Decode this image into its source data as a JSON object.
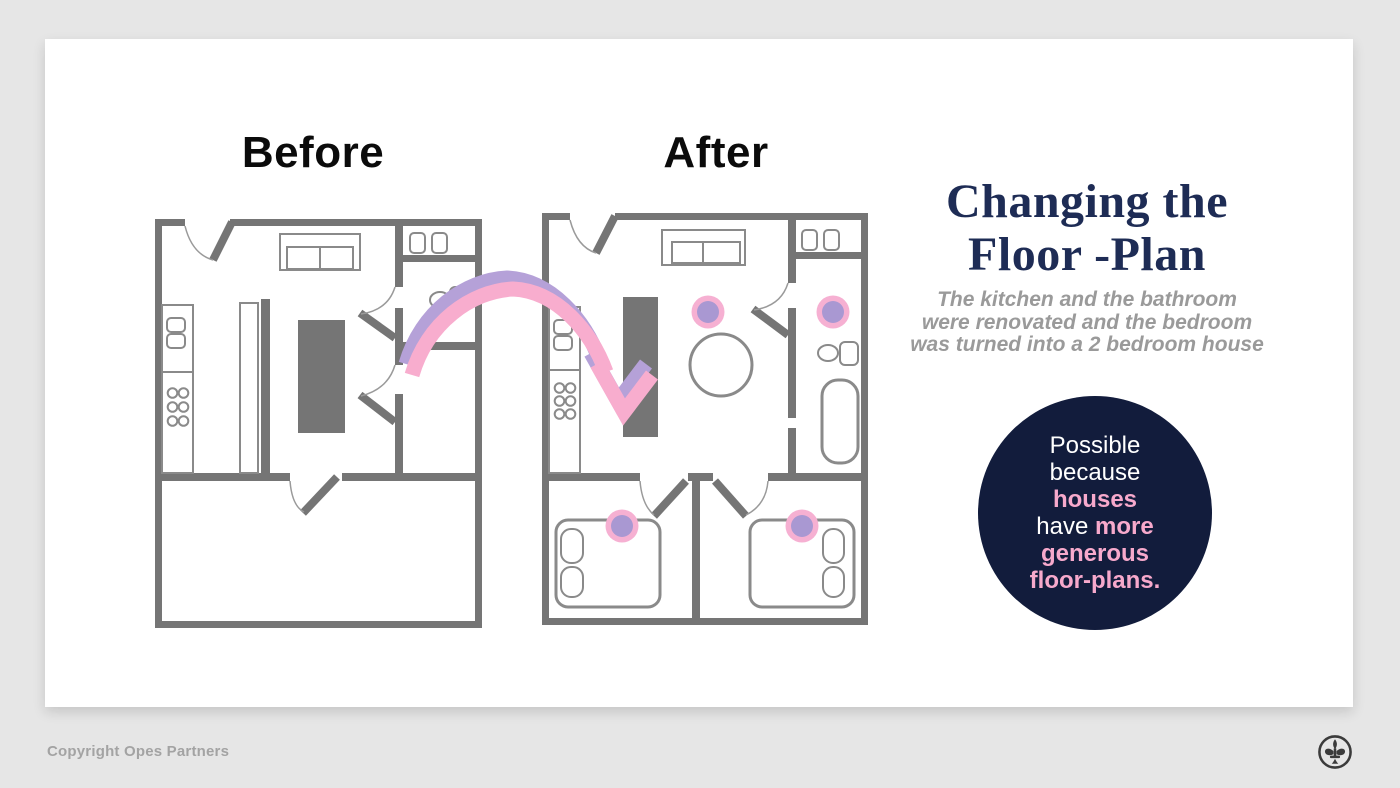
{
  "colors": {
    "page_background": "#e6e6e6",
    "card_background": "#ffffff",
    "wall_gray": "#757575",
    "outline_gray": "#8a8a8a",
    "arrow_pink": "#f8adce",
    "arrow_purple": "#b5a1d8",
    "marker_pink": "#f6b0d2",
    "marker_purple": "#a998d2",
    "title_navy": "#1e2c55",
    "badge_navy": "#121c3c",
    "badge_pink": "#f7a9cc",
    "subtitle_gray": "#9a9a9a"
  },
  "floor_plans": {
    "before": {
      "label": "Before",
      "features": [
        "entry-door",
        "sofa",
        "laundry-fixtures",
        "bathroom-fixtures",
        "kitchen-counter",
        "sink",
        "stove-burners",
        "tall-partition",
        "kitchen-island",
        "interior-doors",
        "large-open-room"
      ]
    },
    "after": {
      "label": "After",
      "features": [
        "entry-door",
        "sofa",
        "laundry-fixtures",
        "bathroom-fixtures",
        "bathtub",
        "kitchen-counter",
        "sink",
        "stove-burners",
        "kitchen-island",
        "round-table",
        "bedroom-1-bed",
        "bedroom-2-bed",
        "interior-doors"
      ],
      "renovation_marker_count": 4
    },
    "arrow": {
      "from": "before",
      "to": "after"
    }
  },
  "panel": {
    "title_line1": "Changing the",
    "title_line2": "Floor -Plan",
    "subtitle_lines": [
      "The kitchen and the bathroom",
      "were renovated and the bedroom",
      "was turned into a 2 bedroom house"
    ]
  },
  "badge": {
    "lines": [
      [
        {
          "t": "Possible",
          "style": "white"
        }
      ],
      [
        {
          "t": "because",
          "style": "white"
        }
      ],
      [
        {
          "t": "houses",
          "style": "pink"
        }
      ],
      [
        {
          "t": "have ",
          "style": "white"
        },
        {
          "t": "more",
          "style": "pink"
        }
      ],
      [
        {
          "t": "generous",
          "style": "pink"
        }
      ],
      [
        {
          "t": "floor-plans.",
          "style": "pink"
        }
      ]
    ]
  },
  "footer": {
    "copyright": "Copyright Opes Partners",
    "logo": "fleur-de-lis"
  }
}
